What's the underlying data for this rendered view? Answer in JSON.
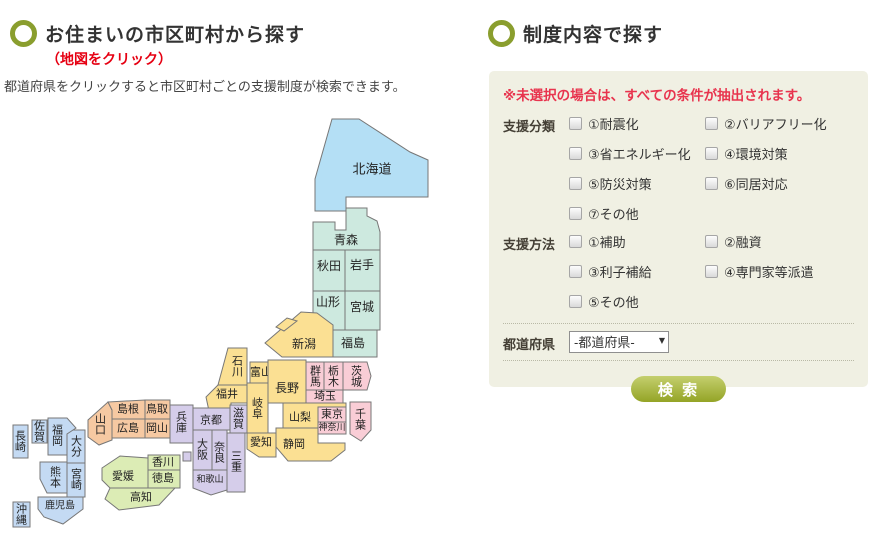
{
  "left_section": {
    "title": "お住まいの市区町村から探す",
    "subtitle": "（地図をクリック）",
    "description": "都道府県をクリックすると市区町村ごとの支援制度が検索できます。"
  },
  "right_section": {
    "title": "制度内容で探す",
    "note": "※未選択の場合は、すべての条件が抽出されます。",
    "support_category": {
      "label": "支援分類",
      "options": [
        "①耐震化",
        "②バリアフリー化",
        "③省エネルギー化",
        "④環境対策",
        "⑤防災対策",
        "⑥同居対応",
        "⑦その他"
      ]
    },
    "support_method": {
      "label": "支援方法",
      "options": [
        "①補助",
        "②融資",
        "③利子補給",
        "④専門家等派遣",
        "⑤その他"
      ]
    },
    "prefecture": {
      "label": "都道府県",
      "selected": "-都道府県-"
    },
    "search_button": "検 索"
  },
  "colors": {
    "accent_ring": "#8a9e2e",
    "map_click_red": "#e60012",
    "note_red": "#e8344e",
    "panel_bg": "#f0f0e3",
    "button_green": "#94a426"
  },
  "map": {
    "region_colors": {
      "hokkaido": "#b4dff5",
      "tohoku": "#cde9df",
      "kanto": "#f9cdd6",
      "chubu": "#fbe093",
      "kinki": "#d5cdea",
      "chugoku": "#f6c9a2",
      "shikoku": "#dcecb5",
      "kyushu": "#c4daf3"
    },
    "prefectures": [
      {
        "id": "hokkaido",
        "name": "北海道",
        "region": "hokkaido",
        "points": "332,19 359,19 410,52 428,60 428,97 346,97 346,111 315,111 315,79",
        "lx": 372,
        "ly": 70,
        "o": "h",
        "fs": 13
      },
      {
        "id": "aomori",
        "name": "青森",
        "region": "tohoku",
        "points": "313,122 335,122 335,130 346,130 346,108 367,108 367,116 377,121 380,132 380,150 313,150",
        "lx": 346,
        "ly": 140,
        "o": "h",
        "fs": 12
      },
      {
        "id": "akita",
        "name": "秋田",
        "region": "tohoku",
        "points": "313,150 345,150 345,191 313,191",
        "lx": 329,
        "ly": 166,
        "o": "h",
        "fs": 12
      },
      {
        "id": "iwate",
        "name": "岩手",
        "region": "tohoku",
        "points": "345,150 380,150 380,191 345,191",
        "lx": 362,
        "ly": 165,
        "o": "h",
        "fs": 12
      },
      {
        "id": "yamagata",
        "name": "山形",
        "region": "tohoku",
        "points": "313,191 345,191 345,230 329,230 313,217",
        "lx": 328,
        "ly": 202,
        "o": "h",
        "fs": 12
      },
      {
        "id": "miyagi",
        "name": "宮城",
        "region": "tohoku",
        "points": "345,191 380,191 380,230 345,230",
        "lx": 362,
        "ly": 207,
        "o": "h",
        "fs": 12
      },
      {
        "id": "fukushima",
        "name": "福島",
        "region": "tohoku",
        "points": "333,230 377,230 377,257 333,257",
        "lx": 353,
        "ly": 243,
        "o": "h",
        "fs": 12
      },
      {
        "id": "niigata",
        "name": "新潟",
        "region": "chubu",
        "points": "317,213 333,225 333,257 282,257 265,243 301,212",
        "lx": 304,
        "ly": 244,
        "o": "h",
        "fs": 12
      },
      {
        "id": "sado",
        "name": "",
        "region": "chubu",
        "points": "276,227 287,218 297,221 284,231",
        "lx": 0,
        "ly": 0,
        "o": "h",
        "fs": 11
      },
      {
        "id": "gunma",
        "name": "群馬",
        "region": "kanto",
        "points": "306,262 324,262 324,290 306,290",
        "lx": 315,
        "ly": 276,
        "o": "v",
        "fs": 11
      },
      {
        "id": "tochigi",
        "name": "栃木",
        "region": "kanto",
        "points": "324,262 343,262 343,290 324,290",
        "lx": 333,
        "ly": 276,
        "o": "v",
        "fs": 11
      },
      {
        "id": "ibaraki",
        "name": "茨城",
        "region": "kanto",
        "points": "343,262 367,262 371,276 367,290 343,290",
        "lx": 356,
        "ly": 276,
        "o": "v",
        "fs": 11
      },
      {
        "id": "saitama",
        "name": "埼玉",
        "region": "kanto",
        "points": "306,290 343,290 343,303 306,303",
        "lx": 325,
        "ly": 296,
        "o": "h",
        "fs": 11
      },
      {
        "id": "yamanashi",
        "name": "山梨",
        "region": "chubu",
        "points": "283,303 346,303 346,307 318,307 318,328 283,328",
        "lx": 300,
        "ly": 317,
        "o": "h",
        "fs": 11
      },
      {
        "id": "tokyo",
        "name": "東京",
        "region": "kanto",
        "points": "318,307 346,307 346,322 318,322",
        "lx": 332,
        "ly": 314,
        "o": "h",
        "fs": 11
      },
      {
        "id": "kanagawa",
        "name": "神奈川",
        "region": "kanto",
        "points": "318,322 346,322 346,334 318,334",
        "lx": 332,
        "ly": 328,
        "o": "h",
        "fs": 9
      },
      {
        "id": "chiba",
        "name": "千葉",
        "region": "kanto",
        "points": "350,302 371,302 371,330 361,341 350,334",
        "lx": 360,
        "ly": 319,
        "o": "v",
        "fs": 11
      },
      {
        "id": "toyama",
        "name": "富山",
        "region": "chubu",
        "points": "250,262 272,262 272,283 250,283",
        "lx": 261,
        "ly": 272,
        "o": "h",
        "fs": 11
      },
      {
        "id": "ishikawa",
        "name": "石川",
        "region": "chubu",
        "points": "228,248 247,248 247,285 218,285",
        "lx": 237,
        "ly": 266,
        "o": "v",
        "fs": 11
      },
      {
        "id": "fukui",
        "name": "福井",
        "region": "chubu",
        "points": "218,285 247,285 247,303 231,303 231,311 209,311 206,297",
        "lx": 227,
        "ly": 294,
        "o": "h",
        "fs": 11
      },
      {
        "id": "gifu",
        "name": "岐阜",
        "region": "chubu",
        "points": "247,283 268,283 268,333 247,333",
        "lx": 257,
        "ly": 308,
        "o": "v",
        "fs": 11
      },
      {
        "id": "nagano",
        "name": "長野",
        "region": "chubu",
        "points": "268,260 306,260 306,303 268,303",
        "lx": 287,
        "ly": 288,
        "o": "h",
        "fs": 12
      },
      {
        "id": "shizuoka",
        "name": "静岡",
        "region": "chubu",
        "points": "276,328 318,328 318,343 345,343 345,350 331,361 288,361 276,347",
        "lx": 294,
        "ly": 344,
        "o": "h",
        "fs": 11
      },
      {
        "id": "aichi",
        "name": "愛知",
        "region": "chubu",
        "points": "247,333 276,333 276,357 259,357 247,349",
        "lx": 261,
        "ly": 342,
        "o": "h",
        "fs": 11
      },
      {
        "id": "kyoto",
        "name": "京都",
        "region": "kinki",
        "points": "193,308 230,308 230,330 193,330",
        "lx": 211,
        "ly": 320,
        "o": "h",
        "fs": 11
      },
      {
        "id": "shiga",
        "name": "滋賀",
        "region": "kinki",
        "points": "230,305 247,305 247,333 230,333",
        "lx": 238,
        "ly": 318,
        "o": "v",
        "fs": 11
      },
      {
        "id": "hyogo",
        "name": "兵庫",
        "region": "kinki",
        "points": "170,305 193,305 193,343 170,343",
        "lx": 181,
        "ly": 322,
        "o": "v",
        "fs": 11
      },
      {
        "id": "osaka",
        "name": "大阪",
        "region": "kinki",
        "points": "193,330 212,330 212,370 193,370",
        "lx": 202,
        "ly": 349,
        "o": "v",
        "fs": 11
      },
      {
        "id": "nara",
        "name": "奈良",
        "region": "kinki",
        "points": "212,330 227,330 227,377 212,377",
        "lx": 219,
        "ly": 352,
        "o": "v",
        "fs": 11
      },
      {
        "id": "mie",
        "name": "三重",
        "region": "kinki",
        "points": "227,333 245,333 245,392 227,392",
        "lx": 236,
        "ly": 361,
        "o": "v",
        "fs": 11
      },
      {
        "id": "wakayama",
        "name": "和歌山",
        "region": "kinki",
        "points": "193,370 227,370 227,390 211,395 193,388",
        "lx": 210,
        "ly": 380,
        "o": "h",
        "fs": 9
      },
      {
        "id": "awaji",
        "name": "",
        "region": "kinki",
        "points": "183,352 191,352 191,361 183,361",
        "lx": 0,
        "ly": 0,
        "o": "h",
        "fs": 11
      },
      {
        "id": "yamaguchi",
        "name": "山口",
        "region": "chugoku",
        "points": "88,320 108,302 112,310 112,340 99,345 88,337",
        "lx": 100,
        "ly": 324,
        "o": "v",
        "fs": 11
      },
      {
        "id": "shimane",
        "name": "島根",
        "region": "chugoku",
        "points": "108,302 145,300 145,319 112,319 112,310",
        "lx": 128,
        "ly": 309,
        "o": "h",
        "fs": 11
      },
      {
        "id": "tottori",
        "name": "鳥取",
        "region": "chugoku",
        "points": "145,300 170,300 170,319 145,319",
        "lx": 157,
        "ly": 309,
        "o": "h",
        "fs": 11
      },
      {
        "id": "hiroshima",
        "name": "広島",
        "region": "chugoku",
        "points": "112,319 145,319 145,338 112,338",
        "lx": 128,
        "ly": 328,
        "o": "h",
        "fs": 11
      },
      {
        "id": "okayama",
        "name": "岡山",
        "region": "chugoku",
        "points": "145,319 170,319 170,338 145,338",
        "lx": 157,
        "ly": 328,
        "o": "h",
        "fs": 11
      },
      {
        "id": "kagawa",
        "name": "香川",
        "region": "shikoku",
        "points": "148,355 180,355 180,370 148,370",
        "lx": 163,
        "ly": 362,
        "o": "h",
        "fs": 11
      },
      {
        "id": "tokushima",
        "name": "徳島",
        "region": "shikoku",
        "points": "148,370 180,370 180,388 148,388",
        "lx": 163,
        "ly": 378,
        "o": "h",
        "fs": 11
      },
      {
        "id": "ehime",
        "name": "愛媛",
        "region": "shikoku",
        "points": "102,368 120,356 148,358 148,388 110,388 102,380",
        "lx": 123,
        "ly": 376,
        "o": "h",
        "fs": 11
      },
      {
        "id": "kochi",
        "name": "高知",
        "region": "shikoku",
        "points": "110,388 175,388 159,405 119,410 105,399",
        "lx": 141,
        "ly": 397,
        "o": "h",
        "fs": 11
      },
      {
        "id": "nagasaki",
        "name": "長崎",
        "region": "kyushu",
        "points": "13,325 28,325 28,358 13,358",
        "lx": 20,
        "ly": 341,
        "o": "v",
        "fs": 11
      },
      {
        "id": "saga",
        "name": "佐賀",
        "region": "kyushu",
        "points": "32,320 47,320 47,343 32,343",
        "lx": 39,
        "ly": 331,
        "o": "v",
        "fs": 11
      },
      {
        "id": "oita",
        "name": "大分",
        "region": "kyushu",
        "points": "67,330 85,330 85,363 67,363",
        "lx": 76,
        "ly": 346,
        "o": "v",
        "fs": 11
      },
      {
        "id": "fukuoka",
        "name": "福岡",
        "region": "kyushu",
        "points": "48,318 67,318 76,328 67,334 67,355 48,355",
        "lx": 57,
        "ly": 335,
        "o": "v",
        "fs": 11
      },
      {
        "id": "kumamoto",
        "name": "熊本",
        "region": "kyushu",
        "points": "40,362 67,362 67,393 47,393 40,379",
        "lx": 55,
        "ly": 377,
        "o": "v",
        "fs": 11
      },
      {
        "id": "miyazaki",
        "name": "宮崎",
        "region": "kyushu",
        "points": "67,363 85,363 85,397 67,397",
        "lx": 76,
        "ly": 379,
        "o": "v",
        "fs": 11
      },
      {
        "id": "kagoshima",
        "name": "鹿児島",
        "region": "kyushu",
        "points": "38,397 83,397 83,409 63,424 44,417 38,409",
        "lx": 60,
        "ly": 406,
        "o": "h",
        "fs": 10
      },
      {
        "id": "okinawa",
        "name": "沖縄",
        "region": "kyushu",
        "points": "13,402 30,402 30,427 13,427",
        "lx": 21,
        "ly": 414,
        "o": "v",
        "fs": 11
      }
    ]
  }
}
